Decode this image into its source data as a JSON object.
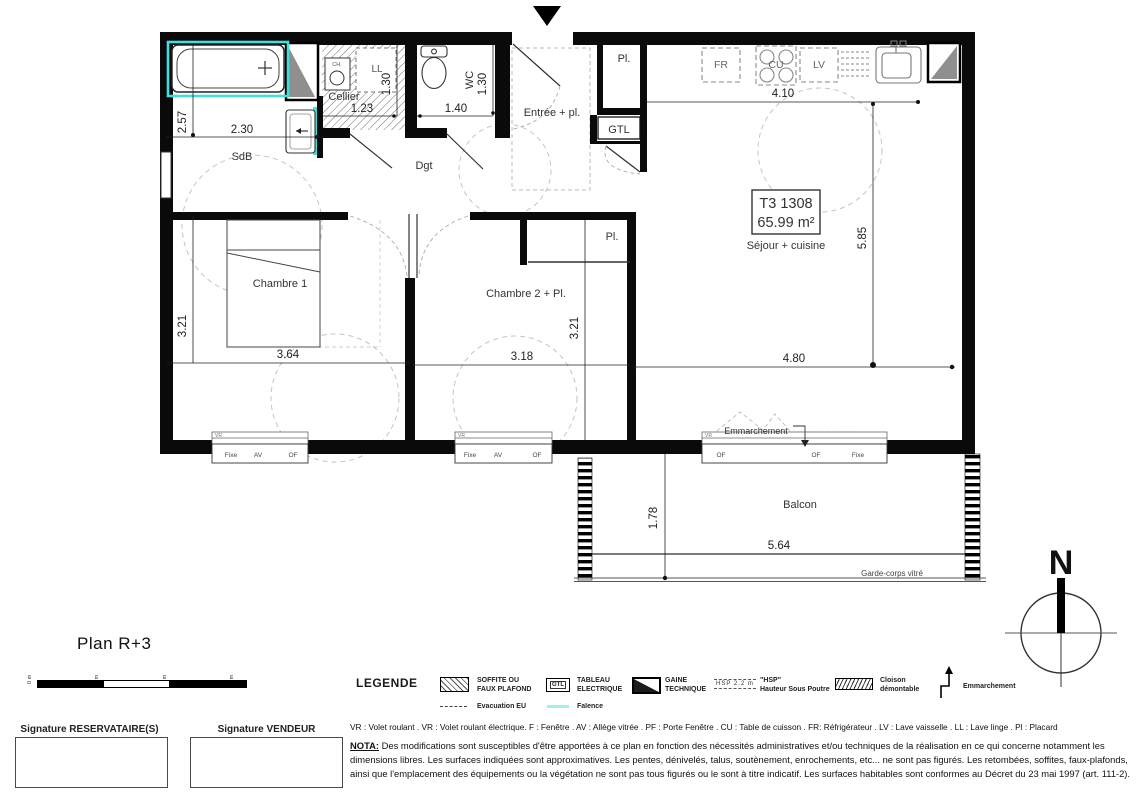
{
  "page": {
    "title": "Plan R+3"
  },
  "plan": {
    "unit": {
      "lot": "T3 1308",
      "area": "65.99 m²",
      "room": "Séjour + cuisine"
    },
    "labels": {
      "sdb": "SdB",
      "cellier": "Cellier",
      "dgt": "Dgt",
      "wc": "WC",
      "entree": "Entrée + pl.",
      "pl": "Pl.",
      "gtl": "GTL",
      "fr": "FR",
      "cu": "CU",
      "lv": "LV",
      "ll": "LL",
      "ch": "CH.",
      "chambre1": "Chambre 1",
      "chambre2": "Chambre 2 + Pl.",
      "pl2": "Pl.",
      "balcon": "Balcon",
      "emmarchement": "Emmarchement",
      "garde_corps": "Garde-corps vitré",
      "vr": "VR",
      "north": "N"
    },
    "dims": {
      "sdb_h": "2.57",
      "sdb_w": "2.30",
      "cellier_w": "1.23",
      "cellier_h": "1.30",
      "wc_w": "1.40",
      "wc_h": "1.30",
      "kitchen_w": "4.10",
      "sejour_h": "5.85",
      "ch1_h": "3.21",
      "ch1_w": "3.64",
      "ch2_w": "3.18",
      "ch2_h": "3.21",
      "sejour_w": "4.80",
      "balcon_d": "1.78",
      "balcon_w": "5.64"
    },
    "windows": {
      "w1": [
        "Fixe",
        "AV",
        "OF"
      ],
      "w2": [
        "Fixe",
        "AV",
        "OF"
      ],
      "w3": [
        "OF",
        "OF",
        "Fixe"
      ]
    }
  },
  "scalebar": {
    "ticks": [
      "0 m",
      "1 m",
      "2 m",
      "3 m"
    ]
  },
  "legend": {
    "heading": "LEGENDE",
    "items": [
      {
        "symbol": "soffite-hatch",
        "label1": "SOFFITE OU",
        "label2": "FAUX PLAFOND"
      },
      {
        "symbol": "gtl-box",
        "symbol_text": "GTL",
        "label1": "TABLEAU",
        "label2": "ELECTRIQUE"
      },
      {
        "symbol": "gaine-box",
        "label1": "GAINE",
        "label2": "TECHNIQUE"
      },
      {
        "symbol": "hsp-dashes",
        "symbol_text": "HSP 2.2 m",
        "label1": "\"HSP\"",
        "label2": "Hauteur Sous Poutre"
      },
      {
        "symbol": "cloison-hatch",
        "label1": "Cloison",
        "label2": "démontable"
      },
      {
        "symbol": "step-arrow",
        "label1": "Emmarchement",
        "label2": ""
      }
    ],
    "row2": [
      {
        "symbol": "dashed-line",
        "label": "Evacuation EU"
      },
      {
        "symbol": "cyan-line",
        "label": "Faïence"
      }
    ]
  },
  "abbreviations": "VR : Volet roulant . VR : Volet roulant électrique. F : Fenêtre . AV : Allège vitrée . PF : Porte Fenêtre . CU : Table de cuisson . FR: Réfrigérateur . LV : Lave vaisselle . LL : Lave linge . Pl : Placard",
  "nota": {
    "heading": "NOTA:",
    "body": " Des modifications sont susceptibles d'être apportées à ce plan en fonction des nécessités administratives et/ou techniques de la réalisation en ce qui concerne notamment les dimensions libres. Les surfaces indiquées sont approximatives. Les pentes, dénivelés, talus, soutènement, enrochements, etc... ne sont pas figurés. Les retombées, soffites, faux-plafonds, ainsi que l'emplacement des équipements ou la végétation ne sont pas tous figurés ou le sont à titre indicatif. Les surfaces habitables sont conformes au Décret du 23 mai 1997 (art. 111-2)."
  },
  "signatures": [
    {
      "label": "Signature RESERVATAIRE(S)"
    },
    {
      "label": "Signature VENDEUR"
    }
  ],
  "colors": {
    "faience": "#3FDFDF",
    "faience_light": "#9FF0F0",
    "gaine_gray": "#8f8f8f"
  }
}
